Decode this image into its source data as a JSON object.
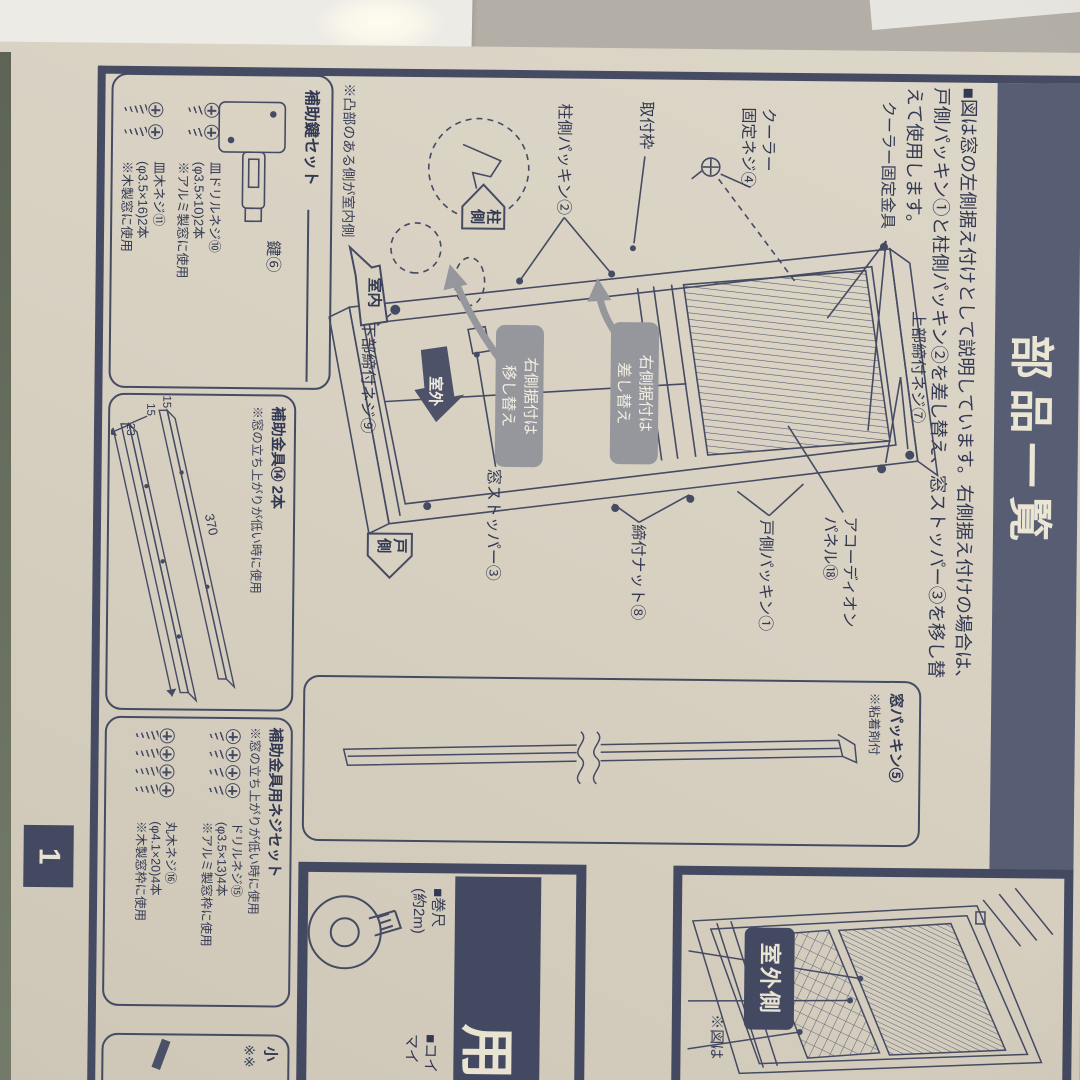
{
  "title": "部品一覧",
  "page_number": "1",
  "intro": {
    "line1": "■図は窓の左側据え付けとして説明しています。右側据え付けの場合は、",
    "line2": "戸側パッキン①と柱側パッキン②を差し替え、窓ストッパー③を移し替",
    "line3": "えて使用します。"
  },
  "diagram": {
    "cooler_bracket": "クーラー固定金具",
    "cooler_screw_line1": "クーラー",
    "cooler_screw_line2": "固定ネジ④",
    "mounting_frame": "取付枠",
    "pillar_packing": "柱側パッキン②",
    "upper_screw": "上部締付ネジ⑦",
    "accordion_line1": "アコーディオン",
    "accordion_line2": "パネル⑱",
    "door_packing": "戸側パッキン①",
    "tightening_nut": "締付ナット⑧",
    "window_stopper": "窓ストッパー③",
    "lower_screw": "下部締付ネジ⑨",
    "badge_swap_line1": "右側据付は",
    "badge_swap_line2": "差し替え",
    "badge_move_line1": "右側据付は",
    "badge_move_line2": "移し替え",
    "arrow_pillar": "柱側",
    "arrow_indoor": "室内",
    "arrow_outdoor": "室外",
    "arrow_door": "戸側"
  },
  "packing_box": {
    "label": "窓パッキン⑤",
    "note": "※粘着剤付"
  },
  "lock_box": {
    "note_above": "※凸部のある側が室内側",
    "title": "補助鍵セット",
    "key_label": "鍵⑥",
    "screw1_name": "皿ドリルネジ⑩",
    "screw1_size": "(φ3.5×10)2本",
    "screw1_note": "※アルミ製窓に使用",
    "screw2_name": "皿木ネジ⑪",
    "screw2_size": "(φ3.5×16)2本",
    "screw2_note": "※木製窓に使用"
  },
  "bracket_box": {
    "title": "補助金具⑭ 2本",
    "note": "※窓の立ち上がりが低い時に使用",
    "dim_len": "370",
    "dim_15a": "15",
    "dim_15b": "15",
    "dim_23": "23"
  },
  "screwset_box": {
    "title": "補助金具用ネジセット",
    "note": "※窓の立ち上がりが低い時に使用",
    "screw1_name": "ドリルネジ⑮",
    "screw1_size": "(φ3.5×13)4本",
    "screw1_note": "※アルミ製窓枠に使用",
    "screw2_name": "丸木ネジ⑯",
    "screw2_size": "(φ4.1×20)4本",
    "screw2_note": "※木製窓枠に使用"
  },
  "next_box": {
    "char1": "小",
    "char2": "※※"
  },
  "prepare": {
    "header_partial": "用",
    "item1_line1": "■巻尺",
    "item1_line2": "(約2m)",
    "item2_line1": "■コイ",
    "item2_line2": "マイ"
  },
  "outdoor": {
    "label": "室外側",
    "note_partial": "※図は"
  },
  "colors": {
    "ink": "#3e4459",
    "band": "#575d73",
    "paper": "#d8d1c2",
    "badge_gray": "#95979c",
    "dark_panel": "#434960"
  }
}
